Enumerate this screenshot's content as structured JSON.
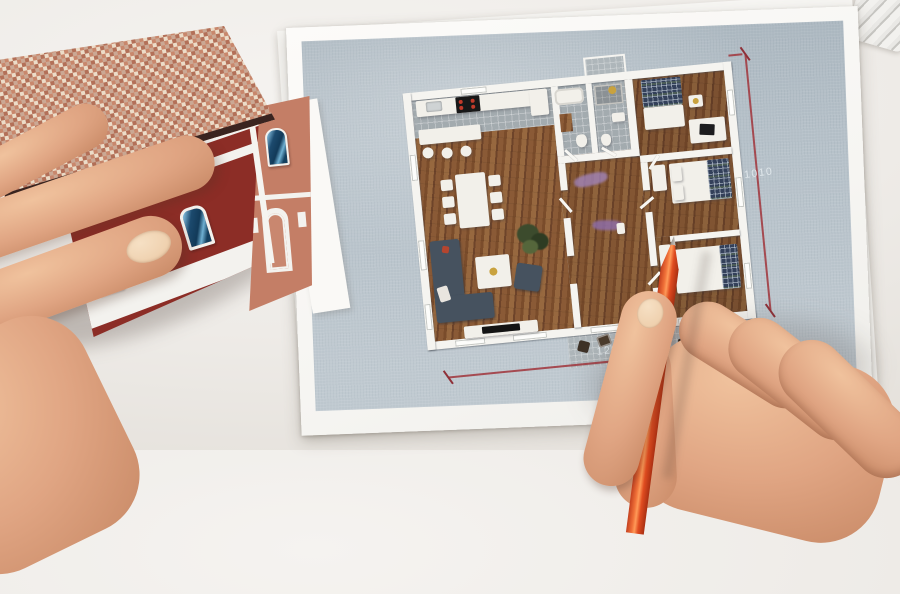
{
  "scene": {
    "objects": {
      "house_model": "paper-house-model",
      "floor_plan": "printed-floor-plan",
      "pencil": "red-pencil",
      "left_hand": "hand-holding-house",
      "right_hand": "hand-holding-pencil"
    }
  },
  "plan": {
    "dimensions": {
      "height_label": "1010",
      "width_label": "1290"
    }
  },
  "palette": {
    "desk": "#eeebe7",
    "paper": "#fbfaf8",
    "plan_background": "#b6c1c9",
    "wood_floor": "#8a5a36",
    "wall_white": "#f5f4f0",
    "dimension_red": "#a23c42",
    "pencil_orange": "#e2451d",
    "house_red": "#8c2d26",
    "gable_salmon": "#c47e66",
    "skin": "#dca180"
  }
}
